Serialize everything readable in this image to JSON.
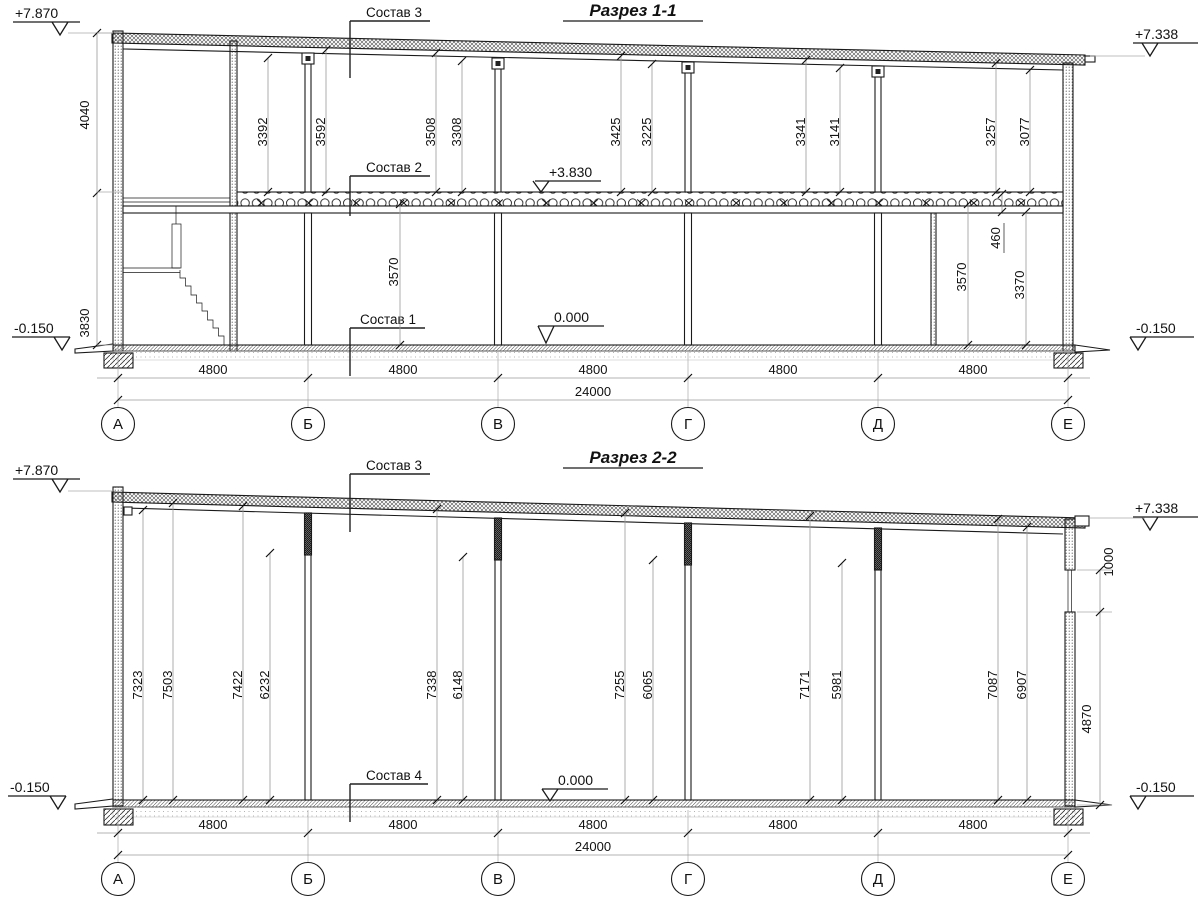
{
  "section1": {
    "title": "Разрез 1-1",
    "labels": {
      "sostav1": "Состав 1",
      "sostav2": "Состав 2",
      "sostav3": "Состав 3"
    },
    "elevations": {
      "top_left": "+7.870",
      "top_right": "+7.338",
      "mid_floor": "+3.830",
      "zero": "0.000",
      "bottom_left": "-0.150",
      "bottom_right": "-0.150"
    },
    "left_dims": {
      "upper": "4040",
      "lower": "3830"
    },
    "upper_dims": [
      "3392",
      "3592",
      "3508",
      "3308",
      "3425",
      "3225",
      "3341",
      "3141",
      "3257",
      "3077"
    ],
    "lower_dims": {
      "d1": "3570",
      "d2": "3570",
      "d3": "460",
      "d4": "3370"
    },
    "bay_dims": [
      "4800",
      "4800",
      "4800",
      "4800",
      "4800"
    ],
    "total_dim": "24000",
    "axes": [
      "А",
      "Б",
      "В",
      "Г",
      "Д",
      "Е"
    ]
  },
  "section2": {
    "title": "Разрез 2-2",
    "labels": {
      "sostav3": "Состав 3",
      "sostav4": "Состав 4"
    },
    "elevations": {
      "top_left": "+7.870",
      "top_right": "+7.338",
      "zero": "0.000",
      "bottom_left": "-0.150",
      "bottom_right": "-0.150"
    },
    "column_dims": [
      "7323",
      "7503",
      "7422",
      "6232",
      "7338",
      "6148",
      "7255",
      "6065",
      "7171",
      "5981",
      "7087",
      "6907"
    ],
    "right_dims": {
      "window": "1000",
      "below": "4870"
    },
    "bay_dims": [
      "4800",
      "4800",
      "4800",
      "4800",
      "4800"
    ],
    "total_dim": "24000",
    "axes": [
      "А",
      "Б",
      "В",
      "Г",
      "Д",
      "Е"
    ]
  }
}
